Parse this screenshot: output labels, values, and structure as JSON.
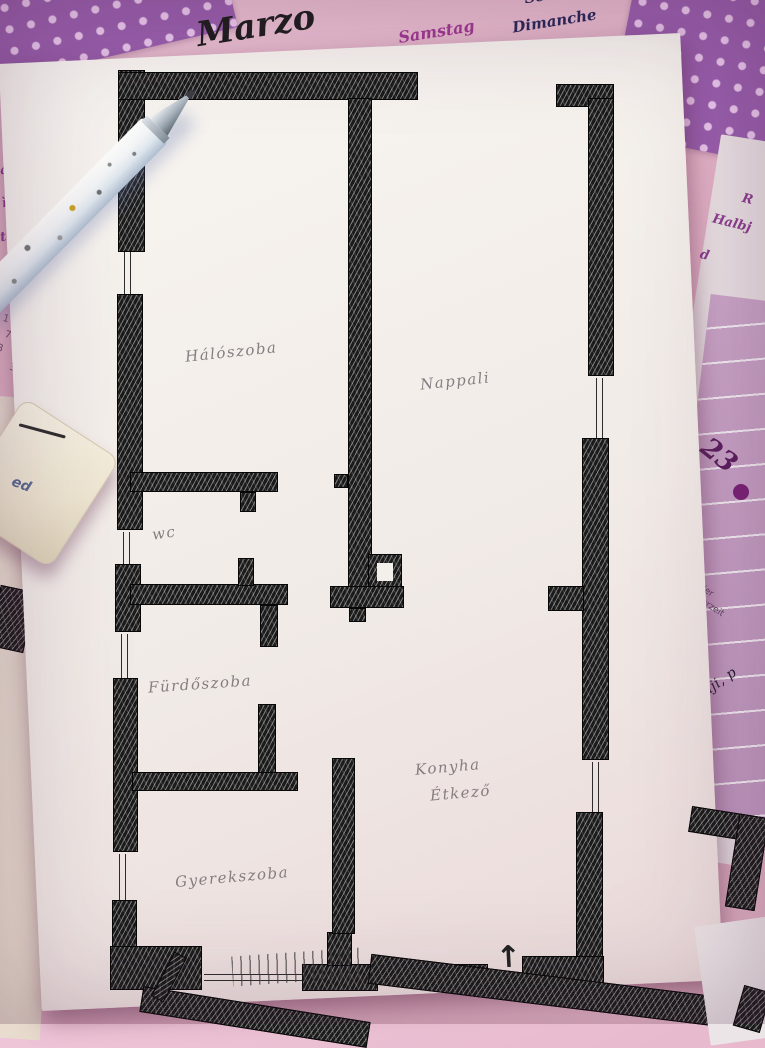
{
  "calendar": {
    "month": "Marzo",
    "day_names_purple": [
      "Samstag",
      "Samedi"
    ],
    "day_names_dark": [
      "Sonntag",
      "Dimanche",
      "Domenica"
    ],
    "left_strip": {
      "fragments": [
        "ag",
        "ì",
        "tedì"
      ],
      "grid_header": "F  S",
      "grid_rows": [
        "3  4",
        "10  11",
        "17  18",
        "23  24",
        "29  30"
      ]
    },
    "right_panel": {
      "day_number": "23",
      "printed_lines": [
        "n der",
        "mmerzeit"
      ],
      "handwriting": ", iebanji, p",
      "fragments": [
        "R",
        "Halbj",
        "d"
      ]
    }
  },
  "floor_plan": {
    "rooms": [
      {
        "id": "haloszoba",
        "label": "Hálószoba"
      },
      {
        "id": "nappali",
        "label": "Nappali"
      },
      {
        "id": "wc",
        "label": "wc"
      },
      {
        "id": "furdoszoba",
        "label": "Fürdőszoba"
      },
      {
        "id": "konyha",
        "label": "Konyha"
      },
      {
        "id": "etkezo",
        "label": "Étkező"
      },
      {
        "id": "gyerekszoba",
        "label": "Gyerekszoba"
      }
    ],
    "entrance": {
      "label": "Bejárat",
      "arrow_icon": "↑"
    }
  },
  "objects": {
    "eraser_text": "ed"
  },
  "colors": {
    "ink": "#1b1b1b",
    "pencil": "#867d81",
    "calendar_pink": "#e5b4c8",
    "polka_purple": "#9a5fae",
    "accent_purple": "#a03a96",
    "dark_day_text": "#28285a",
    "mauve_panel": "#c6a0c4",
    "paper_white": "#f5f1ed"
  }
}
